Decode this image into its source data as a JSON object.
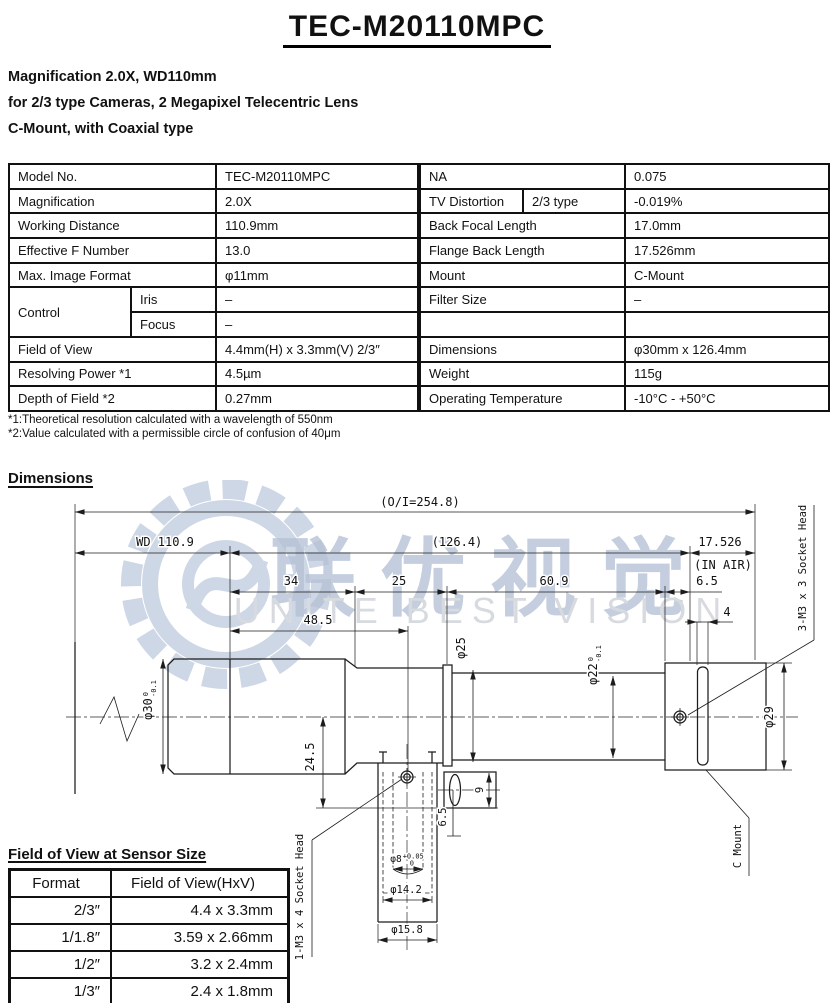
{
  "header": {
    "title": "TEC-M20110MPC",
    "subtitle": [
      "Magnification 2.0X, WD110mm",
      "for 2/3 type Cameras, 2 Megapixel Telecentric Lens",
      "C-Mount, with Coaxial type"
    ]
  },
  "spec": {
    "r1": {
      "ll": "Model No.",
      "lv": "TEC-M20110MPC",
      "rl": "NA",
      "rv": "0.075"
    },
    "r2": {
      "ll": "Magnification",
      "lv": "2.0X",
      "rl": "TV Distortion",
      "rs": "2/3 type",
      "rv": "-0.019%"
    },
    "r3": {
      "ll": "Working Distance",
      "lv": "110.9mm",
      "rl": "Back Focal Length",
      "rv": "17.0mm"
    },
    "r4": {
      "ll": "Effective F Number",
      "lv": "13.0",
      "rl": "Flange Back Length",
      "rv": "17.526mm"
    },
    "r5": {
      "ll": "Max. Image Format",
      "lv": "φ11mm",
      "rl": "Mount",
      "rv": "C-Mount"
    },
    "r6": {
      "ll": "Control",
      "ls": "Iris",
      "lv": "–",
      "rl": "Filter Size",
      "rv": "–"
    },
    "r7": {
      "ls": "Focus",
      "lv": "–",
      "rl": "",
      "rv": ""
    },
    "r8": {
      "ll": "Field of View",
      "lv": "4.4mm(H) x 3.3mm(V) 2/3″",
      "rl": "Dimensions",
      "rv": "φ30mm x 126.4mm"
    },
    "r9": {
      "ll": "Resolving Power *1",
      "lv": "4.5µm",
      "rl": "Weight",
      "rv": "115g"
    },
    "r10": {
      "ll": "Depth of Field *2",
      "lv": "0.27mm",
      "rl": "Operating Temperature",
      "rv": "-10°C - +50°C"
    }
  },
  "footnotes": [
    "*1:Theoretical resolution calculated with a wavelength of 550nm",
    "*2:Value calculated with a permissible circle of confusion of 40μm"
  ],
  "dimensions_heading": "Dimensions",
  "drawing": {
    "overall": "(O/I=254.8)",
    "wd": "WD 110.9",
    "body_len": "(126.4)",
    "flange_back": "17.526",
    "in_air": "(IN AIR)",
    "seg_34": "34",
    "seg_25": "25",
    "seg_609": "60.9",
    "seg_65": "6.5",
    "seg_485": "48.5",
    "seg_4": "4",
    "dia30": {
      "main": "φ30",
      "tol_top": "0",
      "tol_bot": "-0.1"
    },
    "dia25": "φ25",
    "dia22": {
      "main": "φ22",
      "tol_top": "0",
      "tol_bot": "-0.1"
    },
    "dia29": "φ29",
    "dim_245": "24.5",
    "dim_9": "9",
    "dim_65b": "6.5",
    "dia8": {
      "main": "φ8",
      "tol_top": "+0.05",
      "tol_bot": "0"
    },
    "dia142": "φ14.2",
    "dia158": "φ15.8",
    "socket_1m3": "1-M3 x 4 Socket Head",
    "socket_3m3": "3-M3 x 3 Socket Head",
    "c_mount": "C Mount"
  },
  "watermark": {
    "cn": "联优视觉",
    "en": "UNITE BEST VISION"
  },
  "fov_table": {
    "title": "Field of View at Sensor Size",
    "headers": [
      "Format",
      "Field of View(HxV)"
    ],
    "rows": [
      [
        "2/3″",
        "4.4 x 3.3mm"
      ],
      [
        "1/1.8″",
        "3.59 x 2.66mm"
      ],
      [
        "1/2″",
        "3.2 x 2.4mm"
      ],
      [
        "1/3″",
        "2.4 x 1.8mm"
      ]
    ]
  }
}
